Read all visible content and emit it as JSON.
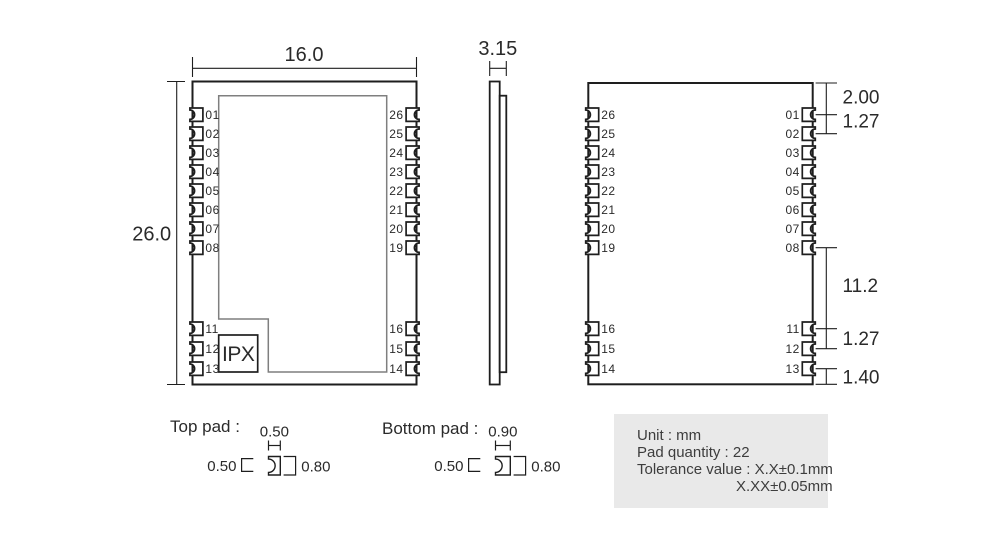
{
  "colors": {
    "line": "#1e1e1e",
    "shield_outline": "#7f7f7f",
    "info_box_bg": "#e9e9e9",
    "text": "#2a2a2a"
  },
  "top_view": {
    "width_dim": "16.0",
    "height_dim": "26.0",
    "ipx_label": "IPX",
    "left_pins": [
      "01",
      "02",
      "03",
      "04",
      "05",
      "06",
      "07",
      "08"
    ],
    "left_pins_lower": [
      "11",
      "12",
      "13"
    ],
    "right_pins": [
      "26",
      "25",
      "24",
      "23",
      "22",
      "21",
      "20",
      "19"
    ],
    "right_pins_lower": [
      "16",
      "15",
      "14"
    ]
  },
  "side_view": {
    "thickness_dim": "3.15"
  },
  "bottom_view": {
    "left_pins": [
      "26",
      "25",
      "24",
      "23",
      "22",
      "21",
      "20",
      "19"
    ],
    "left_pins_lower": [
      "16",
      "15",
      "14"
    ],
    "right_pins": [
      "01",
      "02",
      "03",
      "04",
      "05",
      "06",
      "07",
      "08"
    ],
    "right_pins_lower": [
      "11",
      "12",
      "13"
    ],
    "right_dims": [
      "2.00",
      "1.27",
      "11.2",
      "1.27",
      "1.40"
    ]
  },
  "pad_details": {
    "top_pad": {
      "label": "Top pad :",
      "width_dim": "0.50",
      "notch_dim": "0.50",
      "length_dim": "0.80"
    },
    "bottom_pad": {
      "label": "Bottom pad :",
      "width_dim": "0.90",
      "notch_dim": "0.50",
      "length_dim": "0.80"
    }
  },
  "info_box": {
    "lines": [
      "Unit : mm",
      "Pad quantity : 22",
      "Tolerance value : X.X±0.1mm",
      "X.XX±0.05mm"
    ]
  }
}
